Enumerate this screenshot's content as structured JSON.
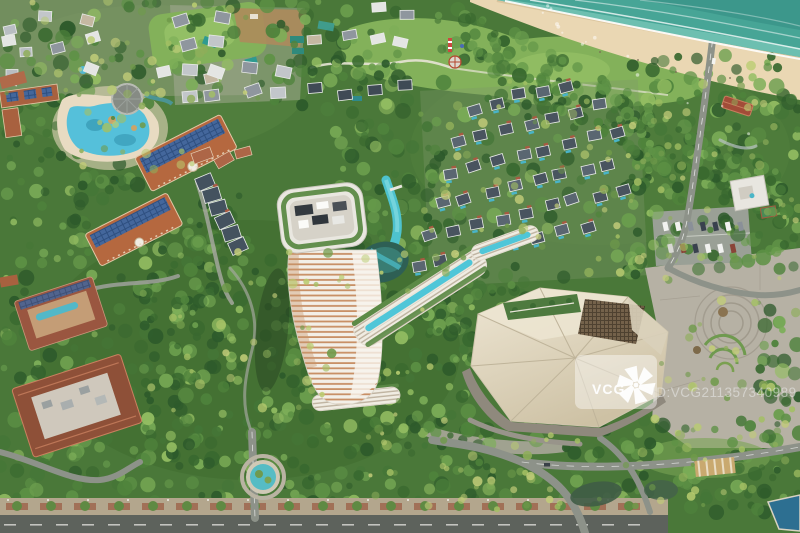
{
  "watermark": {
    "brand": "VCG",
    "id_text": "ID:VCG211357340989"
  },
  "palette": {
    "ocean": "#47a596",
    "ocean_deep": "#3a9488",
    "ocean_shallow": "#7ecabb",
    "sand": "#ead7b3",
    "wet_sand": "#d8c29a",
    "foliage_base": "#4a7839",
    "lawn": "#83b15a",
    "pool_blue": "#55c0da",
    "lagoon": "#4ec2ce",
    "dark_pond": "#2e5f54",
    "terracotta_roof": "#b5683f",
    "solar_panel": "#44679c",
    "villa_roof": "#49545f",
    "villa_roof_alt": "#5a6671",
    "gray_roof": "#b9bec2",
    "tower_stripe": "#c89066",
    "conference_roof": "#e6ddc8",
    "plaza": "#b6b1a4",
    "road": "#8d9289",
    "sidewalk": "#b3a68d",
    "bottom_road": "#5d625c"
  }
}
